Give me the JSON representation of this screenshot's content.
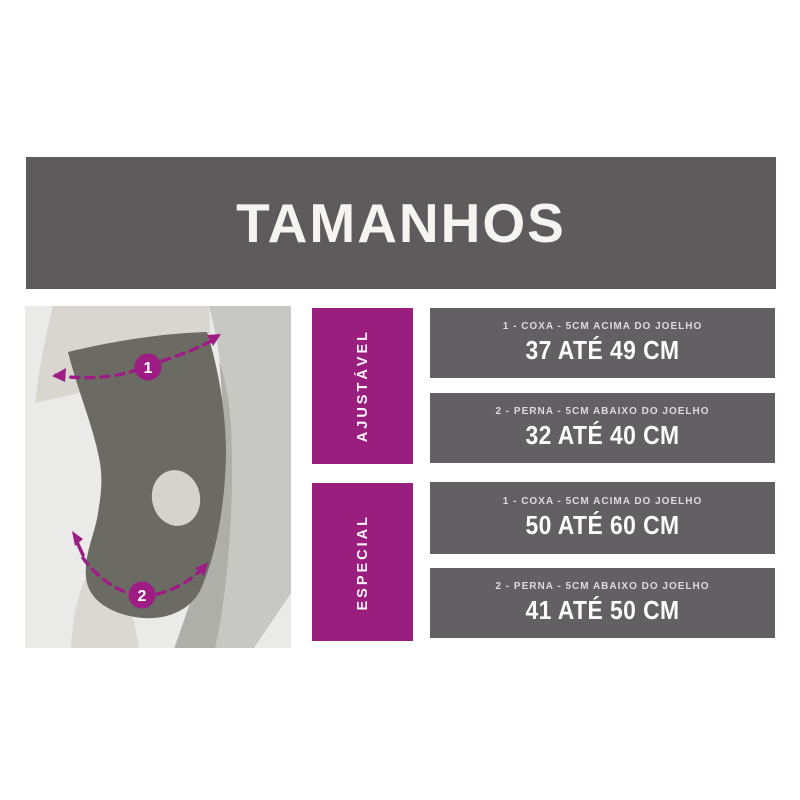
{
  "header": {
    "title": "TAMANHOS"
  },
  "theme": {
    "banner_bg": "#5E5B5D",
    "bar_bg": "#626063",
    "accent_purple": "#9A1E7E",
    "marker_purple": "#9D1D84",
    "panel_bg": "#EAEAE8",
    "brace_gray": "#6B6A63",
    "text_on_dark": "#FCFBFA"
  },
  "groups": [
    {
      "label": "AJUSTÁVEL",
      "rows": [
        {
          "measure": "1 - COXA - 5CM ACIMA DO JOELHO",
          "range": "37 ATÉ 49 CM"
        },
        {
          "measure": "2 - PERNA - 5CM ABAIXO DO JOELHO",
          "range": "32 ATÉ 40 CM"
        }
      ]
    },
    {
      "label": "ESPECIAL",
      "rows": [
        {
          "measure": "1 - COXA - 5CM ACIMA DO JOELHO",
          "range": "50 ATÉ 60 CM"
        },
        {
          "measure": "2 - PERNA - 5CM ABAIXO DO JOELHO",
          "range": "41 ATÉ 50 CM"
        }
      ]
    }
  ],
  "diagram": {
    "markers": [
      {
        "number": "1"
      },
      {
        "number": "2"
      }
    ]
  }
}
